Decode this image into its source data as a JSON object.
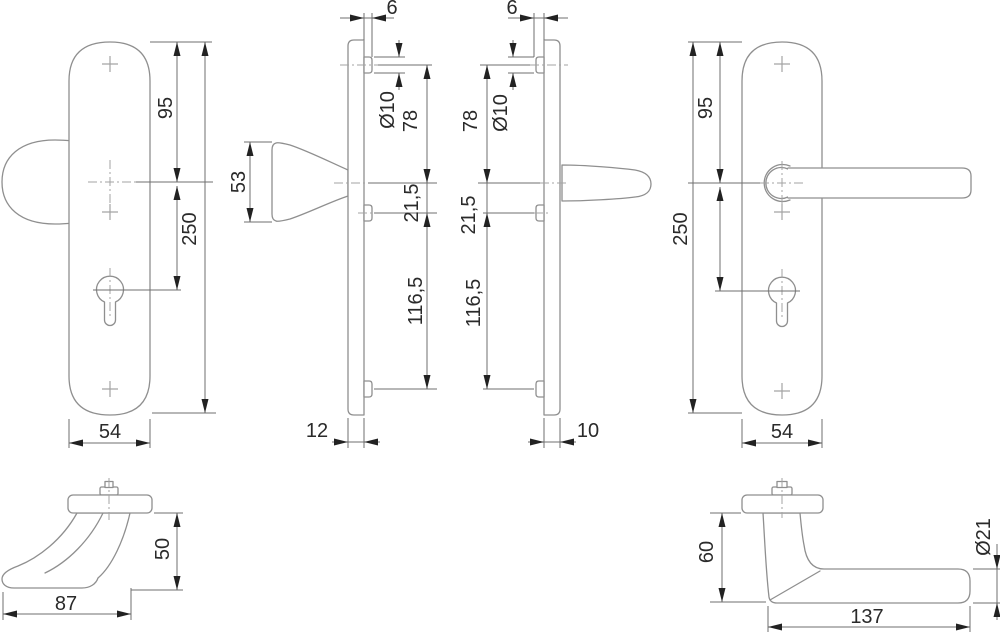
{
  "drawing": {
    "title": "door-handle-security-plate-technical-drawing",
    "views": {
      "front_knob_plate": {
        "dims": {
          "top_to_center": "95",
          "total_height": "250",
          "width": "54"
        }
      },
      "side_knob": {
        "dims": {
          "boss_offset": "6",
          "boss_dia": "Ø10",
          "top_to_center": "78",
          "knob_height": "53",
          "center_to_boss": "21,5",
          "boss_to_boss": "116,5",
          "depth": "12"
        }
      },
      "side_lever": {
        "dims": {
          "boss_offset": "6",
          "top_to_center": "78",
          "boss_dia": "Ø10",
          "center_to_boss": "21,5",
          "boss_to_boss": "116,5",
          "depth": "10"
        }
      },
      "front_lever_plate": {
        "dims": {
          "top_to_center": "95",
          "total_height": "250",
          "width": "54"
        }
      },
      "knob_profile": {
        "dims": {
          "height": "50",
          "length": "87"
        }
      },
      "lever_profile": {
        "dims": {
          "height": "60",
          "grip_dia": "Ø21",
          "length": "137"
        }
      }
    }
  }
}
